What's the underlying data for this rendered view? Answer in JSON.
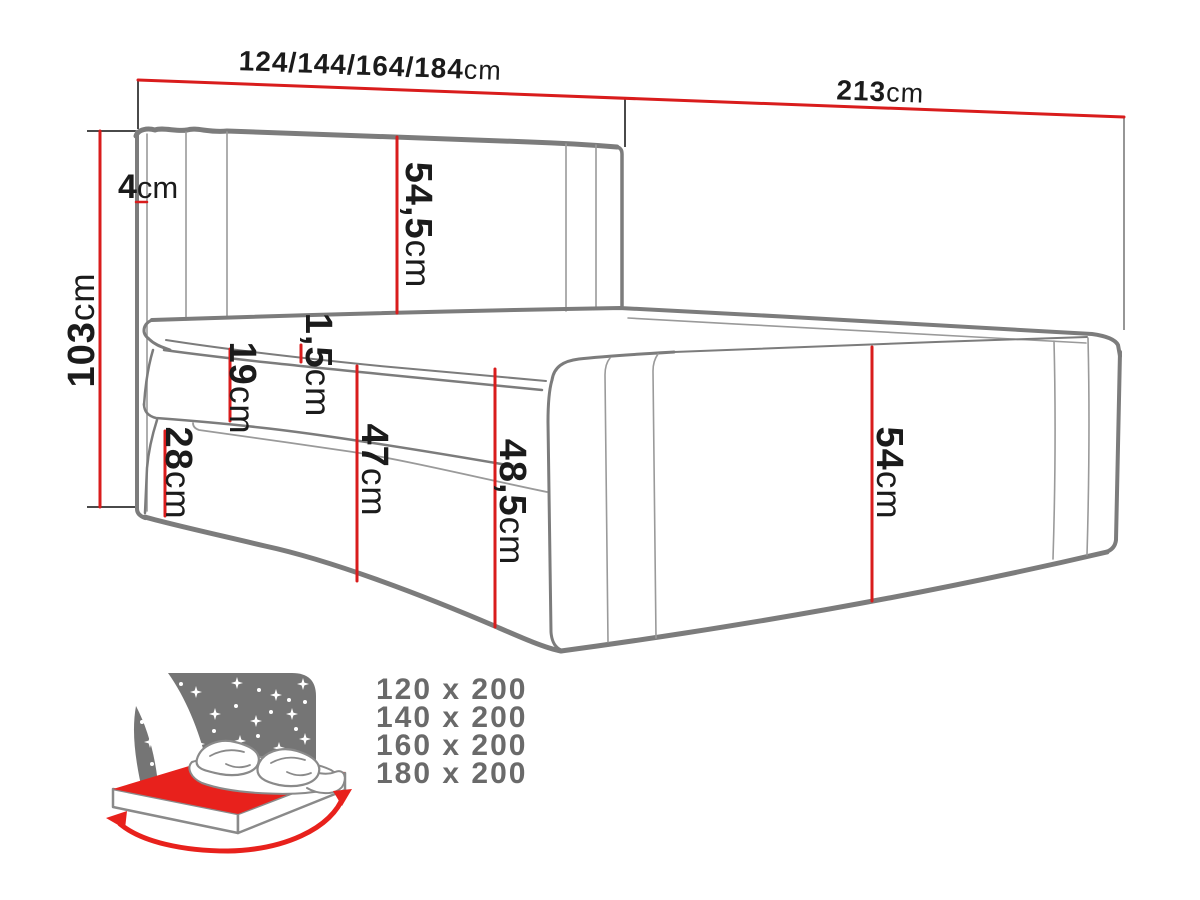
{
  "title": "Bed dimensions diagram",
  "colors": {
    "dimension_red": "#d91c1c",
    "outline_gray": "#7c7c7c",
    "thin_gray": "#9a9a9a",
    "tick_dark": "#4a4a4a",
    "label_black": "#1b1b1b",
    "icon_sky_gray": "#757575",
    "icon_red": "#e8211c",
    "sizes_text_gray": "#6a6a6a"
  },
  "icons": {
    "badge": "starry-night-bed-icon",
    "arrows": "width-length-arrows-icon"
  },
  "dimensions": {
    "width_options": {
      "value": "124/144/164/184",
      "unit": "cm"
    },
    "total_length": {
      "value": "213",
      "unit": "cm"
    },
    "total_height": {
      "value": "103",
      "unit": "cm"
    },
    "headboard_wing": {
      "value": "4",
      "unit": "cm"
    },
    "headboard_panel": {
      "value": "54,5",
      "unit": "cm"
    },
    "mattress_lip": {
      "value": "1,5",
      "unit": "cm"
    },
    "mattress_band": {
      "value": "19",
      "unit": "cm"
    },
    "base_band": {
      "value": "28",
      "unit": "cm"
    },
    "side_front_height": {
      "value": "47",
      "unit": "cm"
    },
    "side_foot_height": {
      "value": "48,5",
      "unit": "cm"
    },
    "side_right_height": {
      "value": "54",
      "unit": "cm"
    }
  },
  "available_sizes": {
    "items": [
      "120 x 200",
      "140 x 200",
      "160 x 200",
      "180 x 200"
    ]
  }
}
